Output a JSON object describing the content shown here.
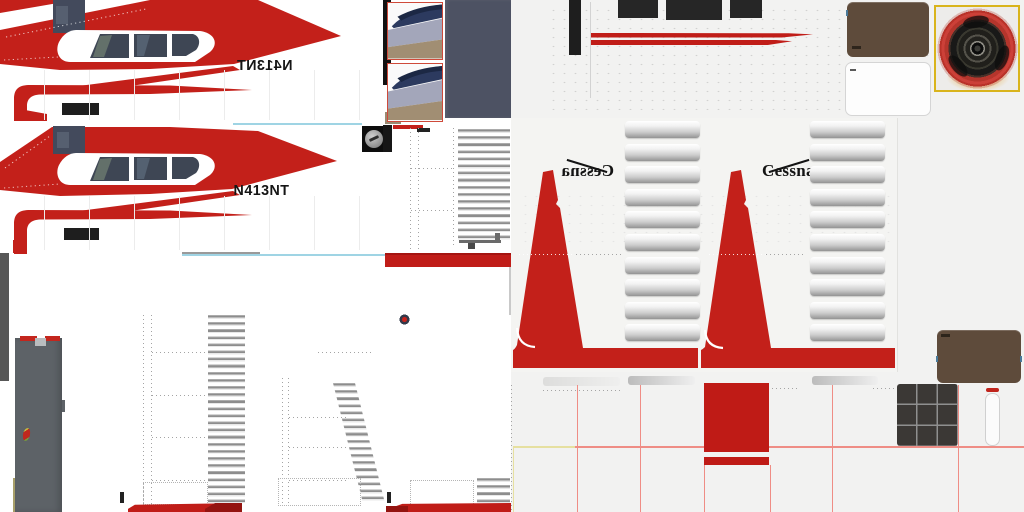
{
  "atlas": {
    "registration": "N413NT",
    "brand": "Cessna"
  },
  "colors": {
    "livery_red": "#c3201a",
    "livery_red_dark": "#941410",
    "stripe_red": "#c01d18",
    "glass_slate": "#3e4654",
    "photo_slate": "#434a5c",
    "panel_slate": "#4d5263",
    "panel_brown": "#5e4b3b",
    "strut_gray": "#5d6267",
    "dark_strip": "#575757",
    "grid_dark": "#3b3835",
    "bg_right": "#f2f2f1",
    "seam_pink": "#ef8d85",
    "seam_cyan": "#9fd4e4",
    "seam_yellow": "#e6e0a0",
    "engine_yellow": "#d9b41c",
    "engine_red": "#b5352c",
    "tile_navy": "#2c3a5f",
    "tile_lavender": "#a3a6ba",
    "tile_tan": "#a18e73",
    "black_part": "#1e1e1e"
  }
}
